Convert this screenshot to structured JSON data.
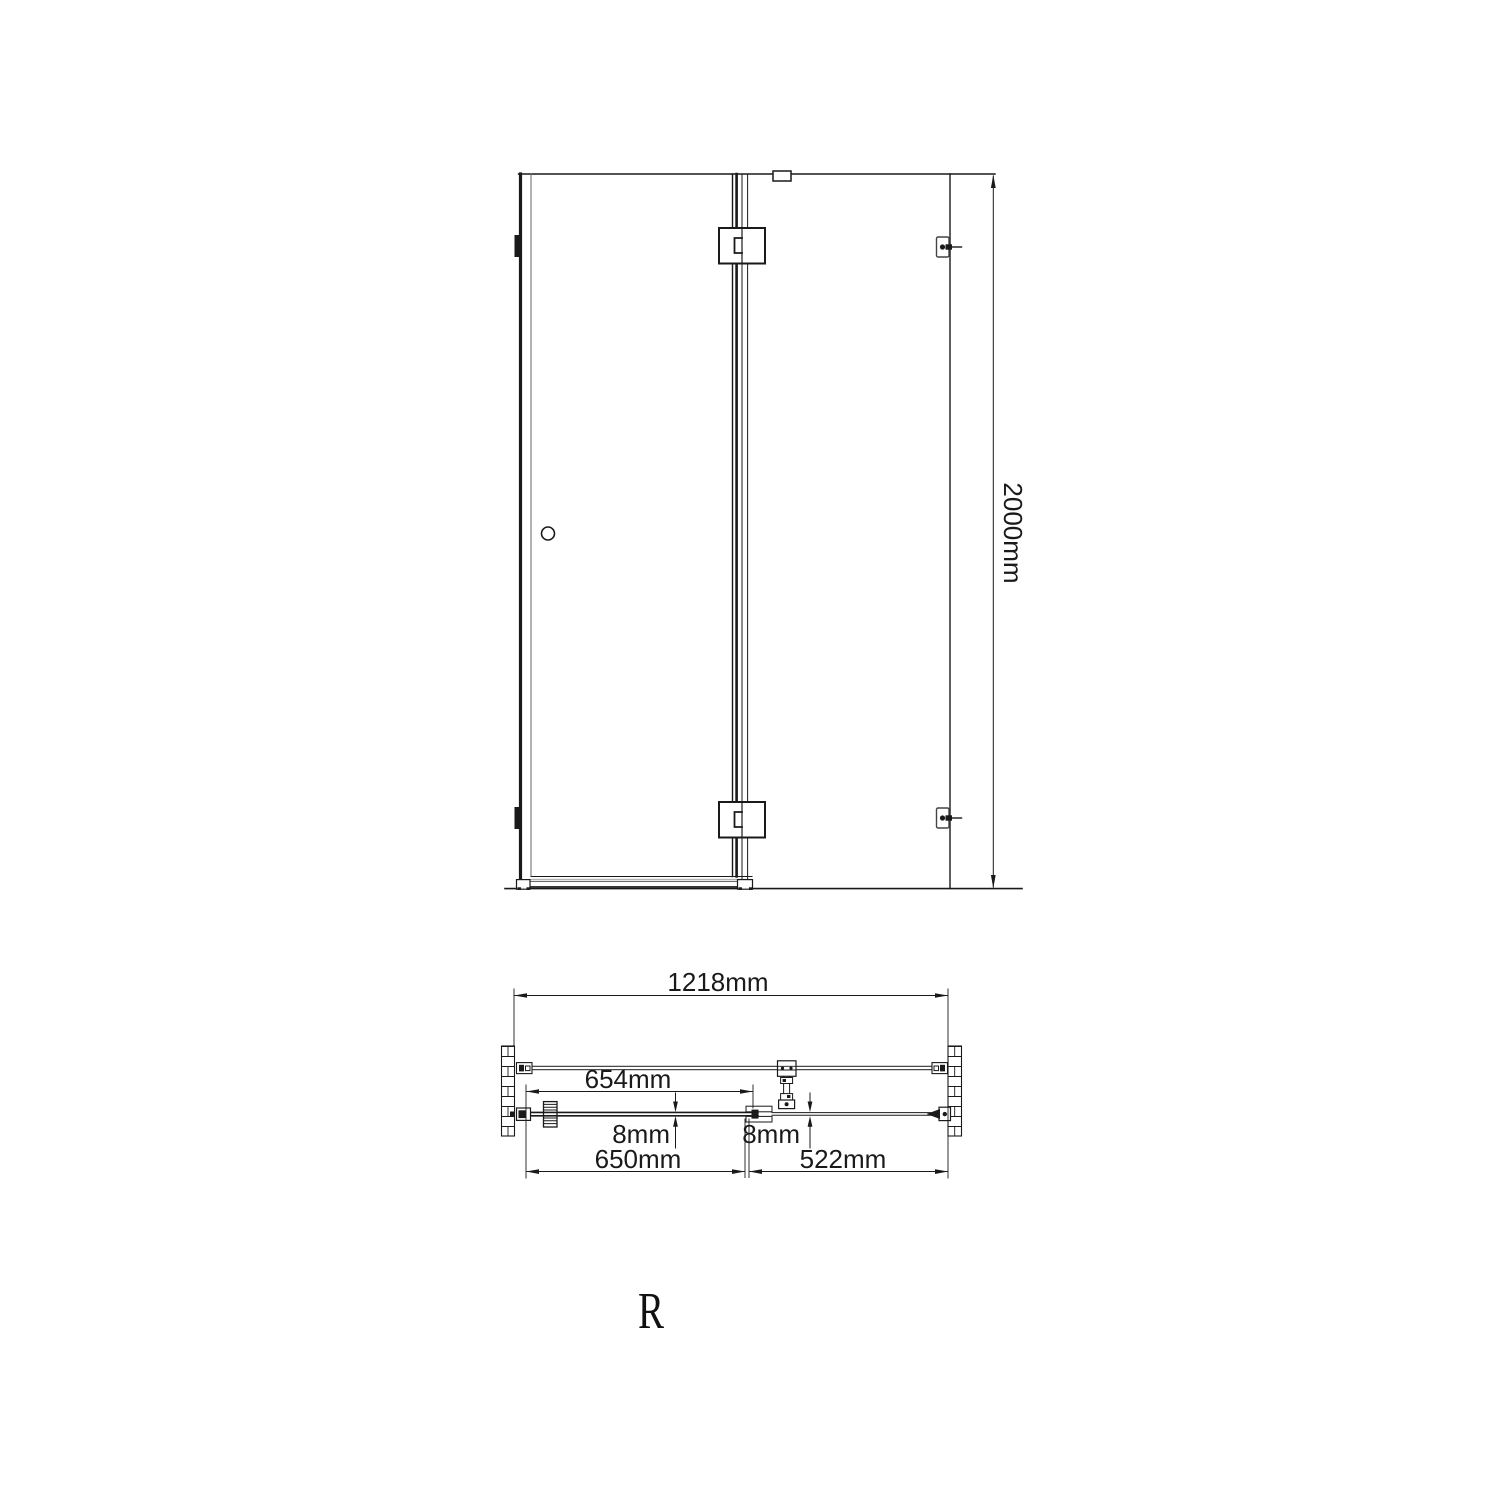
{
  "drawing": {
    "background": "#ffffff",
    "line_color": "#1a1a1a",
    "views": {
      "front_elevation": {
        "description": "shower door front elevation",
        "height_label": "2000mm"
      },
      "plan": {
        "overall_width_label": "1218mm",
        "hinge_offset_label": "654mm",
        "door_glass_thickness_label": "8mm",
        "panel_glass_thickness_label": "8mm",
        "door_width_label": "650mm",
        "side_panel_width_label": "522mm"
      }
    },
    "orientation_label": "R"
  }
}
